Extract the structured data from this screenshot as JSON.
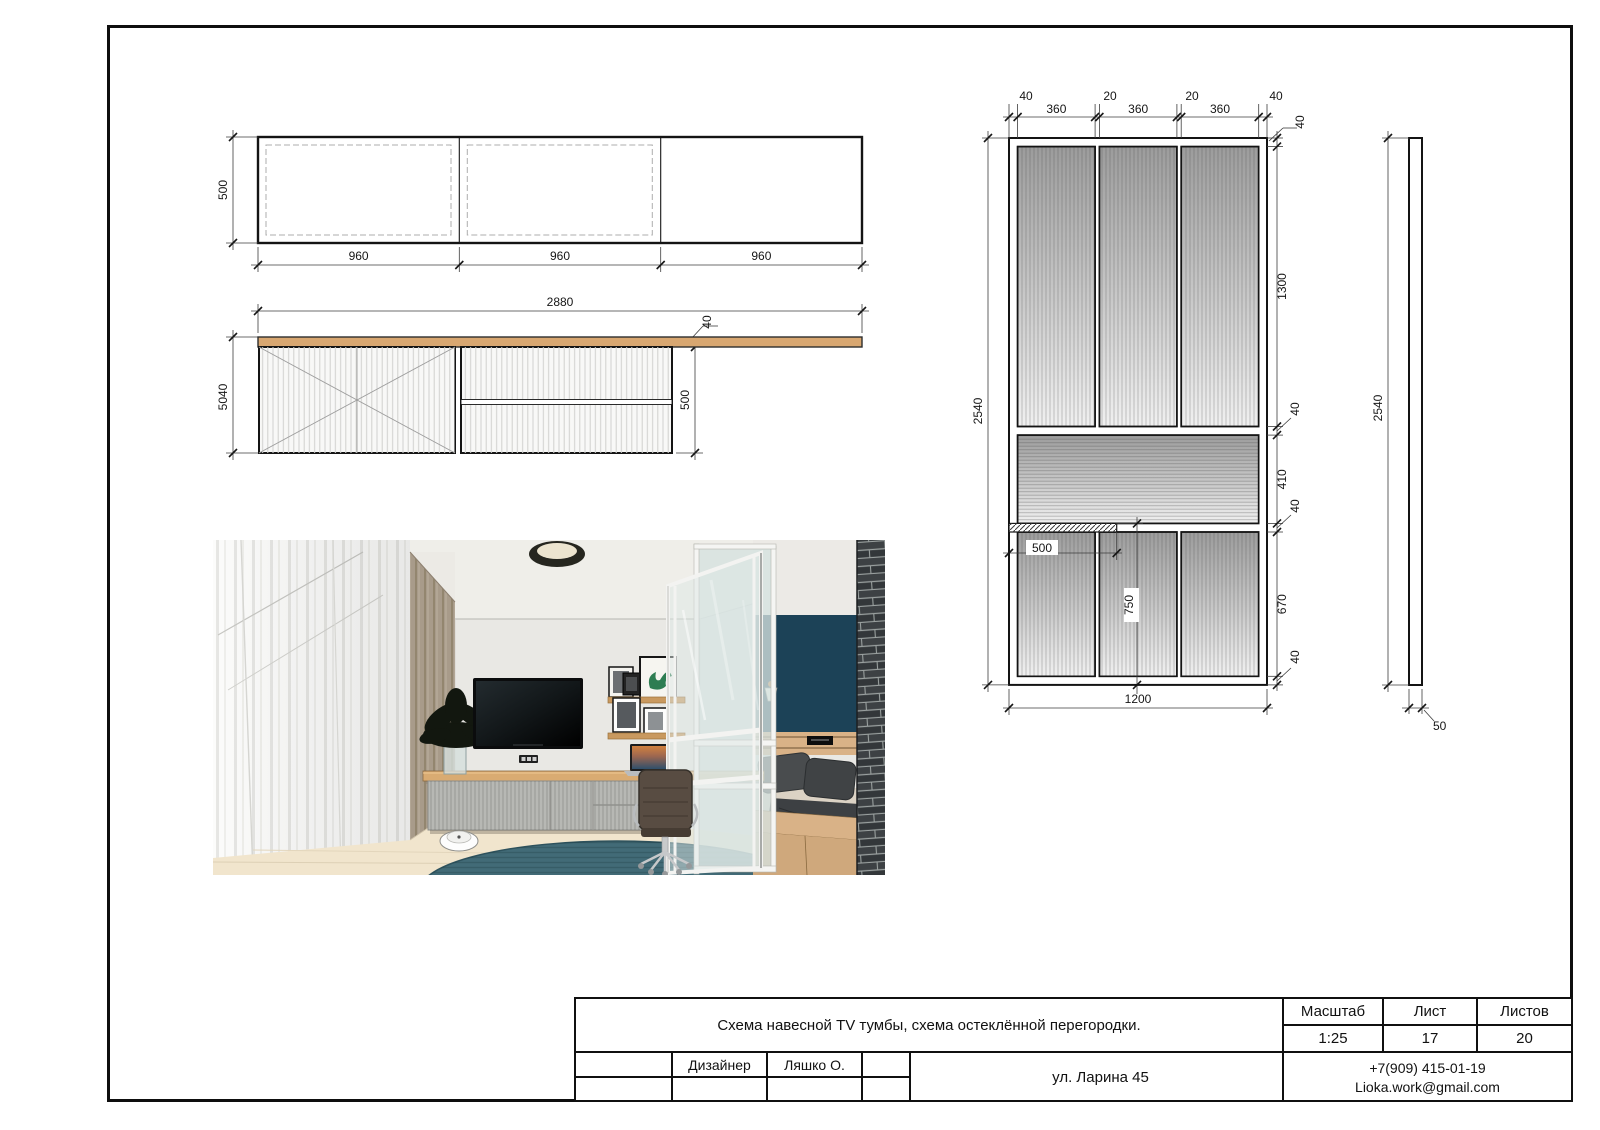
{
  "title_block": {
    "title": "Схема навесной TV тумбы, схема остеклённой перегородки.",
    "scale_label": "Масштаб",
    "scale_value": "1:25",
    "sheet_label": "Лист",
    "sheet_value": "17",
    "sheets_label": "Листов",
    "sheets_value": "20",
    "designer_label": "Дизайнер",
    "designer_name": "Ляшко О.",
    "address": "ул. Ларина 45",
    "phone": "+7(909) 415-01-19",
    "email": "Lioka.work@gmail.com"
  },
  "tv_front": {
    "height": "500",
    "widths": [
      "960",
      "960",
      "960"
    ]
  },
  "tv_section": {
    "width": "2880",
    "top_thickness": "40",
    "height_left": "5040",
    "height_right": "500"
  },
  "partition_front": {
    "top": [
      "40",
      "360",
      "20",
      "360",
      "20",
      "360",
      "40"
    ],
    "frame": "40",
    "right": [
      "1300",
      "40",
      "410",
      "40",
      "670",
      "40"
    ],
    "height": "2540",
    "shelf": "500",
    "lower": "750",
    "width": "1200"
  },
  "partition_side": {
    "height": "2540",
    "thickness": "50"
  },
  "colors": {
    "wood": "#d8a771",
    "navy_wall": "#1c4257",
    "rug": "#426b77",
    "brick": "#33373a",
    "glass": "#dce4e2"
  }
}
